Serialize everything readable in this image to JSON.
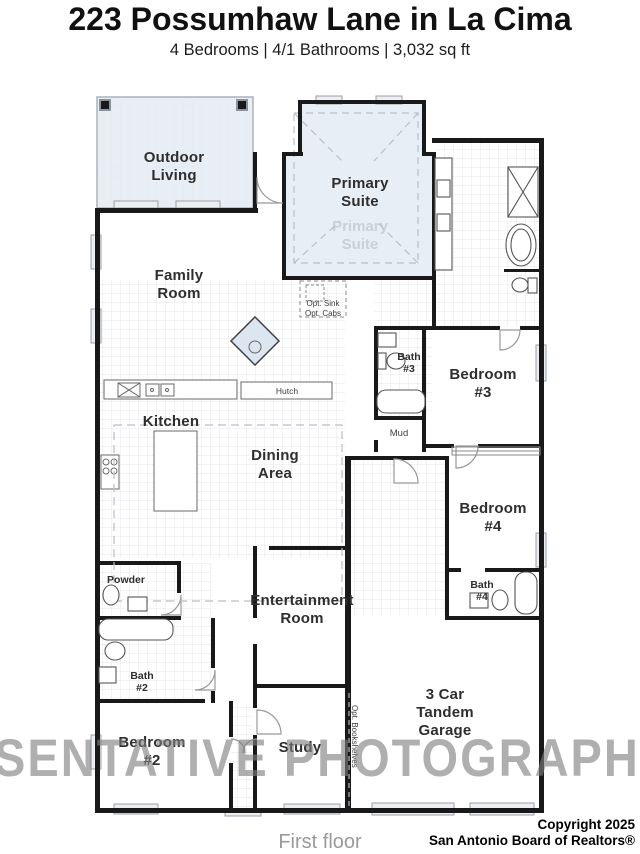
{
  "header": {
    "title": "223 Possumhaw Lane in La Cima",
    "subtitle": "4 Bedrooms | 4/1 Bathrooms | 3,032 sq ft"
  },
  "plan": {
    "rooms": {
      "outdoor_living": [
        "Outdoor",
        "Living"
      ],
      "primary_suite": [
        "Primary",
        "Suite"
      ],
      "primary_suite_ghost": [
        "Primary",
        "Suite"
      ],
      "family_room": [
        "Family",
        "Room"
      ],
      "kitchen": [
        "Kitchen"
      ],
      "dining_area": [
        "Dining",
        "Area"
      ],
      "bath_3": [
        "Bath",
        "#3"
      ],
      "bedroom_3": [
        "Bedroom",
        "#3"
      ],
      "bedroom_4": [
        "Bedroom",
        "#4"
      ],
      "bath_4": [
        "Bath",
        "#4"
      ],
      "powder": [
        "Powder"
      ],
      "bath_2": [
        "Bath",
        "#2"
      ],
      "bedroom_2": [
        "Bedroom",
        "#2"
      ],
      "entertainment_room": [
        "Entertainment",
        "Room"
      ],
      "study": [
        "Study"
      ],
      "garage": [
        "3 Car",
        "Tandem",
        "Garage"
      ],
      "mud": [
        "Mud"
      ]
    },
    "annotations": {
      "opt_sink": "Opt. Sink",
      "opt_cabs": "Opt. Cabs",
      "hutch": "Hutch",
      "opt_bookshelves": "Opt. Bookshelves"
    },
    "floor_label": "First floor"
  },
  "watermark": {
    "text": "SENTATIVE PHOTOGRAPHY"
  },
  "footer": {
    "copyright_line1": "Copyright 2025",
    "copyright_line2": "San Antonio Board of Realtors®"
  },
  "colors": {
    "room_highlight_fill": "#e8eef5",
    "wall": "#191919",
    "watermark_gray": "#7f7f7f",
    "label_text": "#2e2e2e"
  }
}
